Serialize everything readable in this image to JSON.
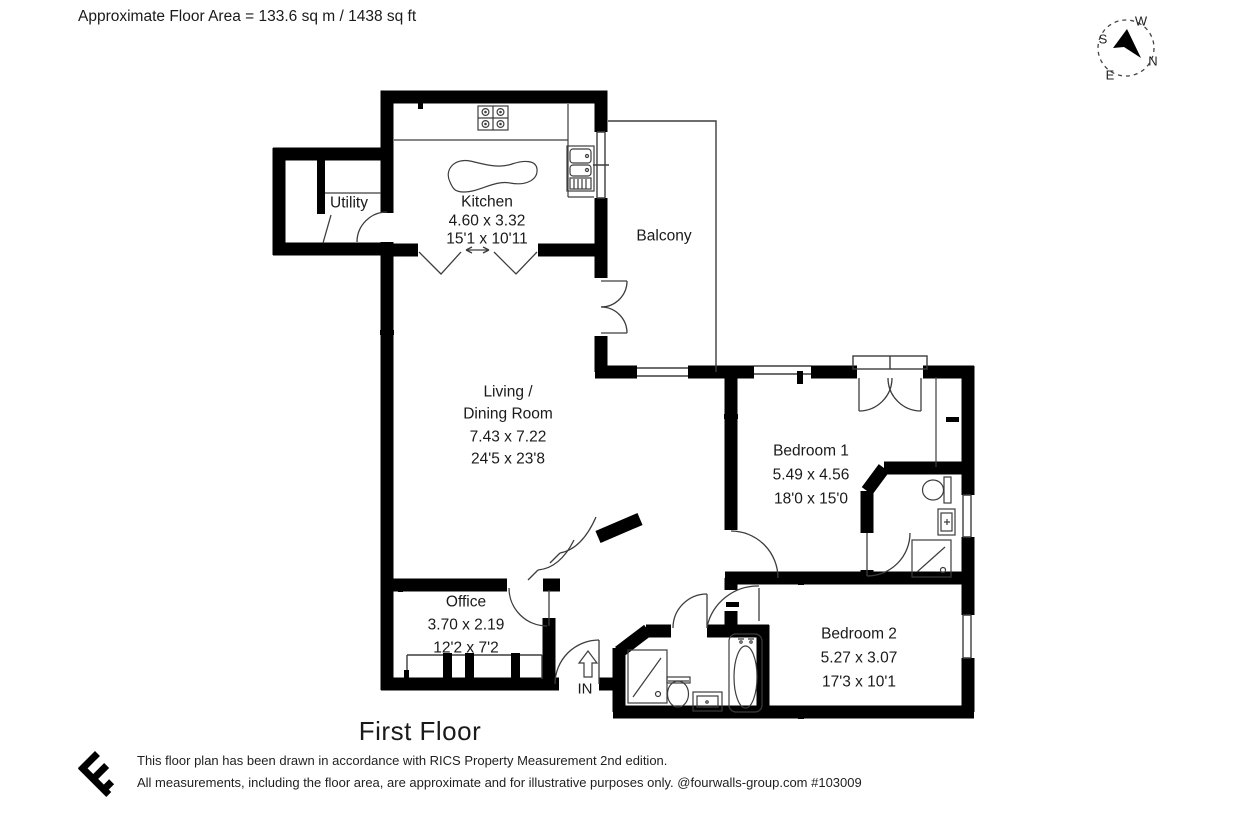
{
  "page": {
    "floor_area_note": "Approximate Floor Area = 133.6 sq m / 1438 sq ft",
    "floor_title": "First Floor",
    "entrance_label": "IN"
  },
  "compass": {
    "n": "N",
    "e": "E",
    "s": "S",
    "w": "W"
  },
  "rooms": {
    "utility": {
      "name": "Utility"
    },
    "kitchen": {
      "name": "Kitchen",
      "size_metric": "4.60 x 3.32",
      "size_imperial": "15'1 x 10'11"
    },
    "balcony": {
      "name": "Balcony"
    },
    "living_dining": {
      "name_line1": "Living /",
      "name_line2": "Dining Room",
      "size_metric": "7.43 x 7.22",
      "size_imperial": "24'5 x 23'8"
    },
    "bedroom1": {
      "name": "Bedroom 1",
      "size_metric": "5.49 x 4.56",
      "size_imperial": "18'0 x 15'0"
    },
    "office": {
      "name": "Office",
      "size_metric": "3.70 x 2.19",
      "size_imperial": "12'2 x 7'2"
    },
    "bedroom2": {
      "name": "Bedroom 2",
      "size_metric": "5.27 x 3.07",
      "size_imperial": "17'3 x 10'1"
    }
  },
  "footer": {
    "line1": "This floor plan has been drawn in accordance with RICS Property Measurement 2nd edition.",
    "line2": "All measurements, including the floor area, are approximate and for illustrative purposes only. @fourwalls-group.com #103009"
  },
  "colors": {
    "wall": "#000000",
    "thin_line": "#3d3d3d",
    "background": "#ffffff",
    "text": "#1a1a1a"
  }
}
